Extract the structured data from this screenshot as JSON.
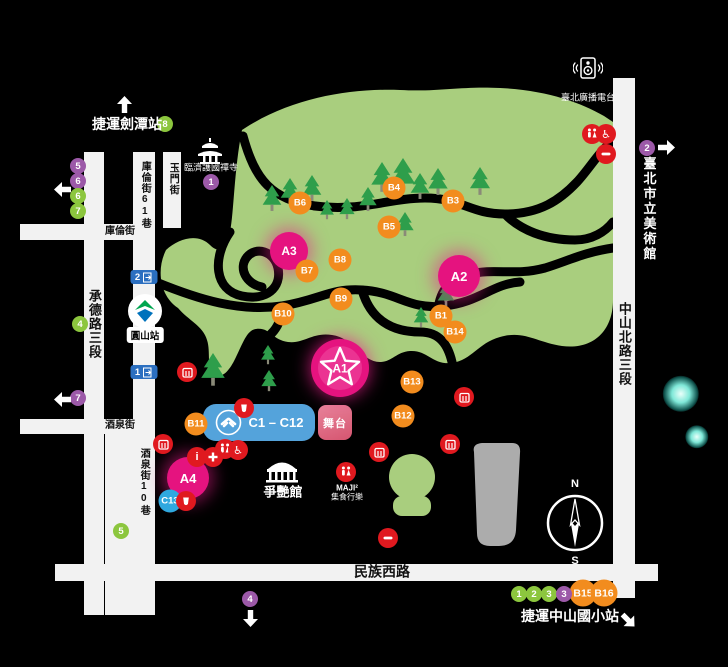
{
  "colors": {
    "pink": "#E5137F",
    "orange": "#F28C1E",
    "c_blue": "#2FA8DF",
    "block_blue": "#54A3DB",
    "green_badge": "#8CC63E",
    "purple": "#9C59A8",
    "red": "#E0191F",
    "park": "#A9CE7E",
    "tree": "#2E9E4B",
    "road": "#F2F2F2",
    "gray": "#ACACAC",
    "stage_pink": "#DD6E84",
    "mrt_blue": "#2B6FC0"
  },
  "legend_labels": {
    "mrt_jiantan": "捷運劍潭站",
    "radio": "臺北廣播電台",
    "temple": "臨濟護國禪寺",
    "museum": "臺北市立美術館",
    "dome": "爭艷館",
    "maji_line1": "MAJI²",
    "maji_line2": "集食行樂",
    "mrt_zhongshan_es": "捷運中山國小站",
    "yuanshan_station": "圓山站",
    "stage": "舞台",
    "c_block": "C1 – C12",
    "compass_n": "N",
    "compass_s": "S"
  },
  "roads": [
    {
      "x": 84,
      "y": 152,
      "w": 20,
      "h": 463,
      "label": "承德路三段",
      "lx": 94,
      "ly": 324,
      "vert": true,
      "fs": 13
    },
    {
      "x": 133,
      "y": 152,
      "w": 22,
      "h": 463,
      "label": "庫倫街61巷",
      "lx": 144,
      "ly": 195,
      "vert": true,
      "fs": 10
    },
    {
      "x": 105,
      "y": 429,
      "w": 30,
      "h": 186,
      "label": "酒泉街10巷",
      "lx": 143,
      "ly": 482,
      "vert": true,
      "fs": 10
    },
    {
      "x": 163,
      "y": 152,
      "w": 18,
      "h": 76,
      "label": "玉門街",
      "lx": 172,
      "ly": 179,
      "vert": true,
      "fs": 10
    },
    {
      "x": 613,
      "y": 78,
      "w": 22,
      "h": 520,
      "label": "中山北路三段",
      "lx": 624,
      "ly": 344,
      "vert": true,
      "fs": 13
    },
    {
      "x": 20,
      "y": 224,
      "w": 115,
      "h": 16,
      "label": "庫倫街",
      "lx": 120,
      "ly": 232,
      "vert": false,
      "fs": 10
    },
    {
      "x": 20,
      "y": 419,
      "w": 115,
      "h": 15,
      "label": "酒泉街",
      "lx": 120,
      "ly": 426,
      "vert": false,
      "fs": 10
    },
    {
      "x": 55,
      "y": 564,
      "w": 603,
      "h": 17,
      "label": "民族西路",
      "lx": 382,
      "ly": 572,
      "vert": false,
      "fs": 14
    }
  ],
  "markers_a": [
    {
      "id": "A1",
      "x": 340,
      "y": 368,
      "r": 28,
      "star": true
    },
    {
      "id": "A2",
      "x": 459,
      "y": 276,
      "r": 21,
      "star": false
    },
    {
      "id": "A3",
      "x": 289,
      "y": 251,
      "r": 19,
      "star": false
    },
    {
      "id": "A4",
      "x": 188,
      "y": 478,
      "r": 21,
      "star": false
    }
  ],
  "markers_b": [
    {
      "id": "B1",
      "x": 441,
      "y": 316
    },
    {
      "id": "B3",
      "x": 453,
      "y": 201
    },
    {
      "id": "B4",
      "x": 394,
      "y": 188
    },
    {
      "id": "B5",
      "x": 389,
      "y": 227
    },
    {
      "id": "B6",
      "x": 300,
      "y": 203
    },
    {
      "id": "B7",
      "x": 307,
      "y": 271
    },
    {
      "id": "B8",
      "x": 340,
      "y": 260
    },
    {
      "id": "B9",
      "x": 341,
      "y": 299
    },
    {
      "id": "B10",
      "x": 283,
      "y": 314
    },
    {
      "id": "B11",
      "x": 196,
      "y": 424
    },
    {
      "id": "B12",
      "x": 403,
      "y": 416
    },
    {
      "id": "B13",
      "x": 412,
      "y": 382
    },
    {
      "id": "B14",
      "x": 455,
      "y": 332
    },
    {
      "id": "B15",
      "x": 583,
      "y": 593,
      "big": true
    },
    {
      "id": "B16",
      "x": 604,
      "y": 593,
      "big": true
    }
  ],
  "marker_c13": {
    "id": "C13",
    "x": 170,
    "y": 501
  },
  "badges": [
    {
      "n": "8",
      "color": "green",
      "x": 165,
      "y": 124
    },
    {
      "n": "5",
      "color": "purple",
      "x": 78,
      "y": 166
    },
    {
      "n": "6",
      "color": "purple",
      "x": 78,
      "y": 181
    },
    {
      "n": "6",
      "color": "green",
      "x": 78,
      "y": 196
    },
    {
      "n": "7",
      "color": "green",
      "x": 78,
      "y": 211
    },
    {
      "n": "4",
      "color": "green",
      "x": 80,
      "y": 324
    },
    {
      "n": "7",
      "color": "purple",
      "x": 78,
      "y": 398
    },
    {
      "n": "1",
      "color": "purple",
      "x": 211,
      "y": 182
    },
    {
      "n": "2",
      "color": "purple",
      "x": 647,
      "y": 148
    },
    {
      "n": "5",
      "color": "green",
      "x": 121,
      "y": 531
    },
    {
      "n": "1",
      "color": "green",
      "x": 519,
      "y": 594
    },
    {
      "n": "2",
      "color": "green",
      "x": 534,
      "y": 594
    },
    {
      "n": "3",
      "color": "green",
      "x": 549,
      "y": 594
    },
    {
      "n": "3",
      "color": "purple",
      "x": 564,
      "y": 594
    },
    {
      "n": "4",
      "color": "purple",
      "x": 250,
      "y": 599
    }
  ],
  "facilities": [
    {
      "type": "stall",
      "x": 187,
      "y": 372
    },
    {
      "type": "stall",
      "x": 163,
      "y": 444
    },
    {
      "type": "drink",
      "x": 244,
      "y": 408
    },
    {
      "type": "restroom",
      "x": 225,
      "y": 449
    },
    {
      "type": "wheelchair",
      "x": 238,
      "y": 450
    },
    {
      "type": "info",
      "x": 197,
      "y": 457
    },
    {
      "type": "firstaid",
      "x": 213,
      "y": 457
    },
    {
      "type": "drink",
      "x": 186,
      "y": 501
    },
    {
      "type": "restroom",
      "x": 592,
      "y": 134
    },
    {
      "type": "wheelchair",
      "x": 606,
      "y": 134
    },
    {
      "type": "minus",
      "x": 606,
      "y": 154
    },
    {
      "type": "stall",
      "x": 464,
      "y": 397
    },
    {
      "type": "stall",
      "x": 450,
      "y": 444
    },
    {
      "type": "stall",
      "x": 379,
      "y": 452
    },
    {
      "type": "minus",
      "x": 388,
      "y": 538
    },
    {
      "type": "restroom",
      "x": 346,
      "y": 472
    }
  ],
  "trees": [
    {
      "x": 272,
      "y": 185,
      "h": 27
    },
    {
      "x": 290,
      "y": 178,
      "h": 27
    },
    {
      "x": 312,
      "y": 175,
      "h": 27
    },
    {
      "x": 327,
      "y": 200,
      "h": 20
    },
    {
      "x": 347,
      "y": 198,
      "h": 22
    },
    {
      "x": 368,
      "y": 187,
      "h": 25
    },
    {
      "x": 382,
      "y": 162,
      "h": 31
    },
    {
      "x": 403,
      "y": 158,
      "h": 35
    },
    {
      "x": 420,
      "y": 173,
      "h": 27
    },
    {
      "x": 438,
      "y": 168,
      "h": 28
    },
    {
      "x": 480,
      "y": 167,
      "h": 29
    },
    {
      "x": 405,
      "y": 212,
      "h": 25
    },
    {
      "x": 446,
      "y": 283,
      "h": 24
    },
    {
      "x": 421,
      "y": 307,
      "h": 21
    },
    {
      "x": 213,
      "y": 353,
      "h": 34
    },
    {
      "x": 268,
      "y": 345,
      "h": 20
    },
    {
      "x": 269,
      "y": 370,
      "h": 22
    }
  ],
  "arrows": [
    {
      "dir": "up",
      "x": 124,
      "y": 104
    },
    {
      "dir": "left",
      "x": 62,
      "y": 189
    },
    {
      "dir": "left",
      "x": 62,
      "y": 399
    },
    {
      "dir": "right",
      "x": 666,
      "y": 147
    },
    {
      "dir": "down",
      "x": 250,
      "y": 618
    },
    {
      "dir": "downright",
      "x": 628,
      "y": 620
    }
  ],
  "exits": [
    {
      "n": "2",
      "x": 144,
      "y": 277
    },
    {
      "n": "1",
      "x": 144,
      "y": 372
    }
  ],
  "glows": [
    {
      "x": 681,
      "y": 394,
      "r": 14
    },
    {
      "x": 697,
      "y": 437,
      "r": 9
    }
  ]
}
